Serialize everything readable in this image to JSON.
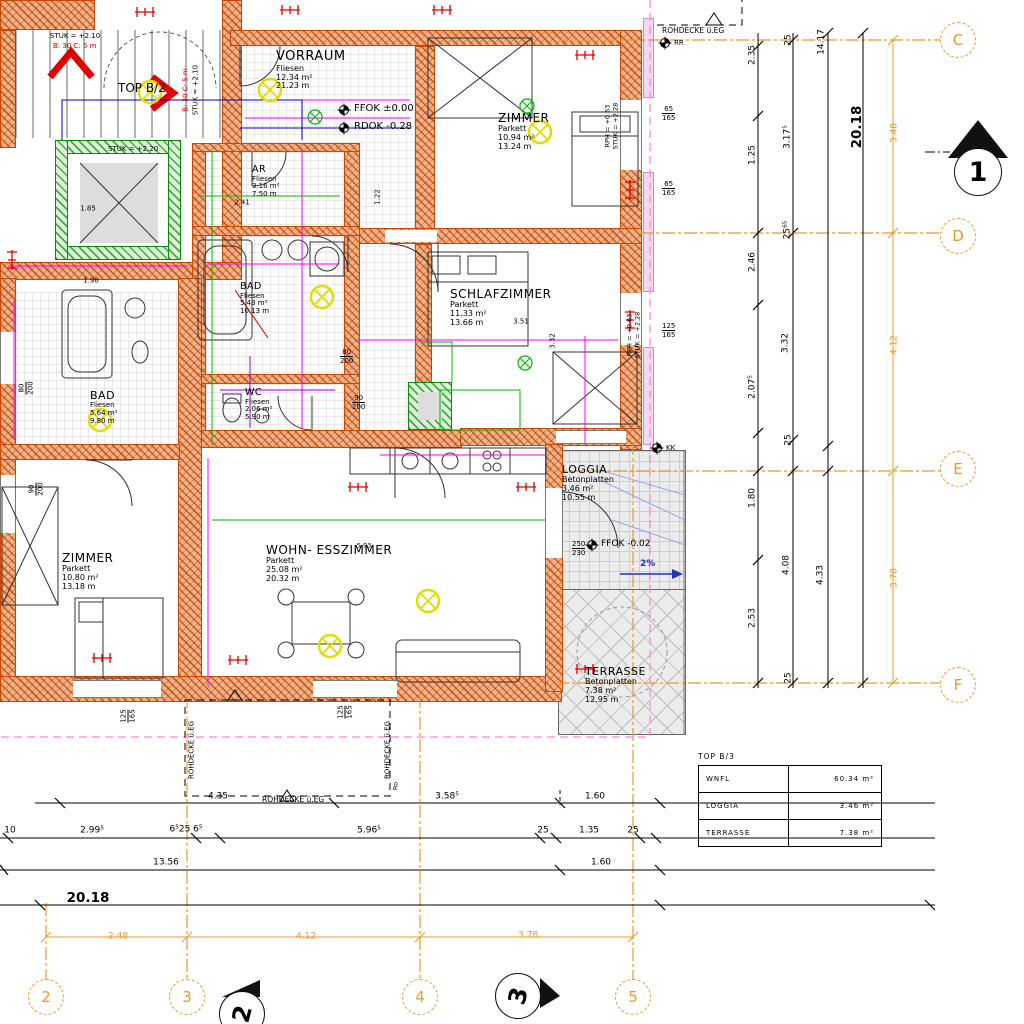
{
  "colors": {
    "axis": "#E8992D",
    "wall": "#C84800",
    "magenta": "#FF00FF",
    "green": "#00B400",
    "blue": "#0000C8",
    "yellow": "#E3DC00",
    "red": "#E00000",
    "roof_pink": "#FF8AD8"
  },
  "rooms": [
    {
      "name": "VORRAUM",
      "finish": "Fliesen",
      "area": "12.34 m²",
      "perimeter": "21.23 m"
    },
    {
      "name": "ZIMMER",
      "finish": "Parkett",
      "area": "10.94 m²",
      "perimeter": "13.24 m"
    },
    {
      "name": "SCHLAFZIMMER",
      "finish": "Parkett",
      "area": "11.33 m²",
      "perimeter": "13.66 m"
    },
    {
      "name": "AR",
      "finish": "Fliesen",
      "area": "3.16 m²",
      "perimeter": "7.50 m"
    },
    {
      "name": "BAD",
      "finish": "Fliesen",
      "area": "5.43 m²",
      "perimeter": "10.13 m"
    },
    {
      "name": "WC",
      "finish": "Fliesen",
      "area": "2.06 m²",
      "perimeter": "5.90 m"
    },
    {
      "name": "BAD",
      "finish": "Fliesen",
      "area": "5.64 m²",
      "perimeter": "9.80 m"
    },
    {
      "name": "ZIMMER",
      "finish": "Parkett",
      "area": "10.80 m²",
      "perimeter": "13.18 m"
    },
    {
      "name": "WOHN- ESSZIMMER",
      "finish": "Parkett",
      "area": "25.08 m²",
      "perimeter": "20.32 m"
    },
    {
      "name": "LOGGIA",
      "finish": "Betonplatten",
      "area": "3.46 m²",
      "perimeter": "10.55 m"
    },
    {
      "name": "TERRASSE",
      "finish": "Betonplatten",
      "area": "7.38 m²",
      "perimeter": "12.95 m"
    }
  ],
  "levels": {
    "ffok": "FFOK ±0.00",
    "rdok": "RDOK -0.28",
    "ffok_loggia": "FFOK -0.02",
    "slope": "2%",
    "door_w": "250",
    "door_h": "230"
  },
  "stair": {
    "top": "TOP B/2",
    "stuk_a": "STUK = +2.10",
    "b_line": "B: 30 C: 5 m",
    "stuk_b": "STUK = +2.20"
  },
  "win_note": {
    "rph": "RPH = +0.63",
    "stuk": "STUK = +2.28"
  },
  "markers": {
    "rr": "RR",
    "kk": "KK",
    "ro": "Ro",
    "rohdecke": "ROHDECKE ü.EG"
  },
  "axes": {
    "rows": [
      "C",
      "D",
      "E",
      "F"
    ],
    "cols": [
      "2",
      "3",
      "4",
      "5"
    ],
    "sec1": "1",
    "sec2": "2",
    "sec3": "3"
  },
  "dims": {
    "rA": [
      "2.35",
      "1.25",
      "2.46",
      "2.07⁵",
      "1.80",
      "2.53"
    ],
    "rB": [
      "25",
      "3.17⁵",
      "25⁶⁵",
      "3.32",
      "25",
      "4.08",
      "25"
    ],
    "rC": [
      "14.17",
      "4.33"
    ],
    "rD": [
      "20.18"
    ],
    "rO": [
      "3.48",
      "4.12",
      "3.78"
    ],
    "b1": [
      "4.35",
      "3.58⁵",
      "1.60"
    ],
    "b2": [
      "10",
      "2.99⁵",
      "6⁵25 6⁵",
      "5.96⁵",
      "25",
      "1.35",
      "25"
    ],
    "b3": [
      "13.56",
      "1.60"
    ],
    "b4": [
      "20.18"
    ],
    "bO": [
      "2.48",
      "4.12",
      "3.78"
    ],
    "inplan": [
      "2.41",
      "1.22",
      "1.85",
      "1.98",
      "5.93",
      "3.51",
      "3.32"
    ]
  },
  "wtags": [
    {
      "t": "65",
      "b": "165"
    },
    {
      "t": "65",
      "b": "165"
    },
    {
      "t": "125",
      "b": "165"
    },
    {
      "t": "125",
      "b": "165"
    },
    {
      "t": "125",
      "b": "165"
    },
    {
      "t": "80",
      "b": "200"
    },
    {
      "t": "90",
      "b": "200"
    },
    {
      "t": "80",
      "b": "200"
    },
    {
      "t": "90",
      "b": "200"
    }
  ],
  "table": {
    "title": "TOP B/3",
    "rows": [
      {
        "k": "WNFL",
        "v": "60.34 m²"
      },
      {
        "k": "LOGGIA",
        "v": "3.46 m²"
      },
      {
        "k": "TERRASSE",
        "v": "7.38 m²"
      }
    ]
  }
}
